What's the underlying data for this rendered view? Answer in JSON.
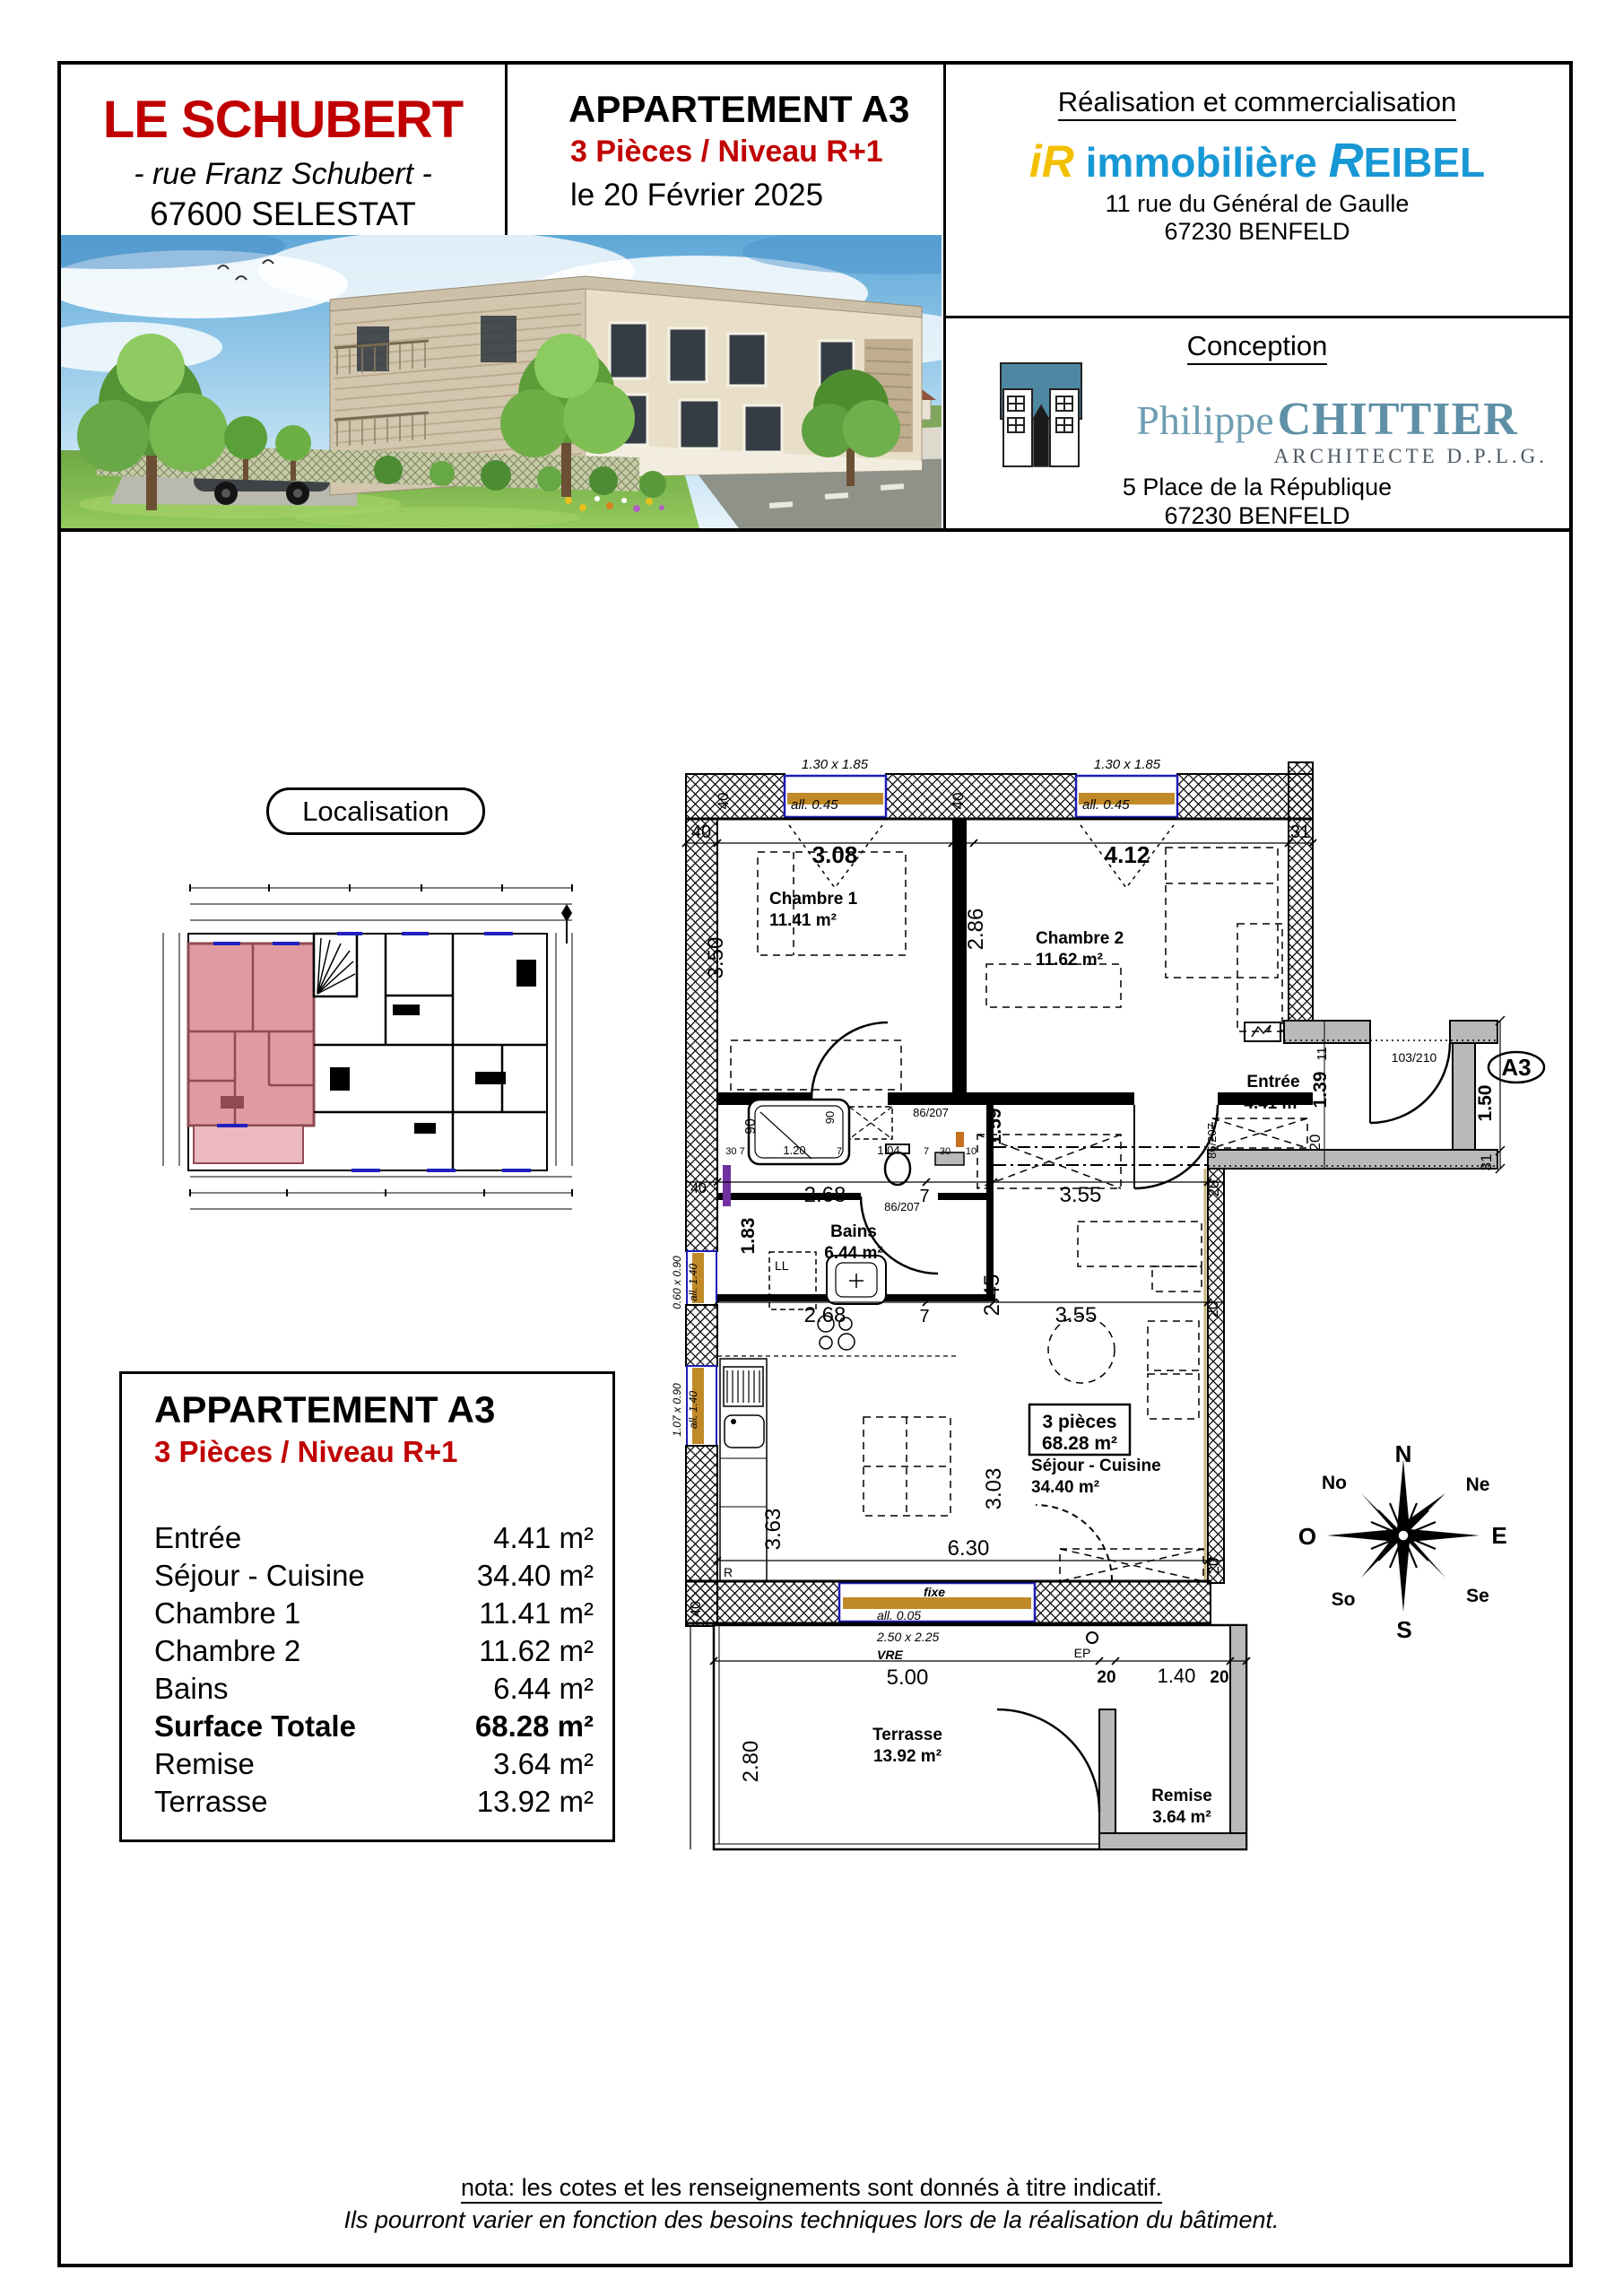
{
  "header": {
    "title": "LE SCHUBERT",
    "street": "- rue Franz Schubert -",
    "city": "67600 SELESTAT",
    "apartment": "APPARTEMENT A3",
    "type": "3 Pièces / Niveau R+1",
    "date": "le 20 Février 2025",
    "realisation": {
      "heading": "Réalisation et commercialisation",
      "logo_i": "iR",
      "logo_name": "immobilière",
      "logo_r": "R",
      "logo_rest": "EIBEL",
      "address1": "11 rue du Général de Gaulle",
      "address2": "67230 BENFELD"
    },
    "conception": {
      "heading": "Conception",
      "architect_first": "Philippe",
      "architect_last": "CHITTIER",
      "architect_title": "ARCHITECTE D.P.L.G.",
      "address1": "5 Place de la République",
      "address2": "67230 BENFELD"
    }
  },
  "localisation_label": "Localisation",
  "surface_table": {
    "title": "APPARTEMENT A3",
    "subtitle": "3 Pièces / Niveau R+1",
    "rows": [
      {
        "label": "Entrée",
        "value": "4.41 m²"
      },
      {
        "label": "Séjour - Cuisine",
        "value": "34.40 m²"
      },
      {
        "label": "Chambre 1",
        "value": "11.41 m²"
      },
      {
        "label": "Chambre 2",
        "value": "11.62 m²"
      },
      {
        "label": "Bains",
        "value": "6.44 m²"
      },
      {
        "label": "Surface Totale",
        "value": "68.28 m²"
      },
      {
        "label": "Remise",
        "value": "3.64 m²"
      },
      {
        "label": "Terrasse",
        "value": "13.92 m²"
      }
    ]
  },
  "plan": {
    "badge": "A3",
    "texts": [
      "1.30 x 1.85",
      "1.30 x 1.85",
      "all. 0.45",
      "all. 0.45",
      "40",
      "3.08",
      "7",
      "4.12",
      "31",
      "40",
      "40",
      "Chambre 1",
      "11.41 m²",
      "Chambre 2",
      "11.62 m²",
      "3.50",
      "2.86",
      "86/207",
      "Entrée",
      "4.41 m²",
      "11",
      "1.39",
      "20",
      "103/210",
      "A3",
      "1.50",
      "31",
      "86/207",
      "1.59",
      "90",
      "90",
      "30 7",
      "1.20",
      "7",
      "1.04",
      "7",
      "30",
      "10",
      "2.68",
      "7",
      "3.55",
      "20",
      "40",
      "86/207",
      "Bains",
      "6.44 m²",
      "1.83",
      "LL",
      "2.45",
      "2.68",
      "7",
      "3.55",
      "20",
      "0.60 x 0.90",
      "all. 1.40",
      "1.07 x 0.90",
      "all. 1.40",
      "3 pièces",
      "68.28 m²",
      "Séjour - Cuisine",
      "34.40 m²",
      "3.03",
      "3.63",
      "6.30",
      "20",
      "R",
      "fixe",
      "all. 0.05",
      "2.50 x 2.25",
      "VRE",
      "EP",
      "5.00",
      "20",
      "1.40",
      "20",
      "2.80",
      "Terrasse",
      "13.92 m²",
      "Remise",
      "3.64 m²",
      "40"
    ]
  },
  "compass": {
    "points": [
      "N",
      "Ne",
      "E",
      "Se",
      "S",
      "So",
      "O",
      "No"
    ]
  },
  "footer": {
    "line1": "nota: les cotes et les renseignements sont donnés à titre indicatif.",
    "line2": "Ils pourront varier en fonction des besoins techniques lors de la réalisation du bâtiment."
  }
}
